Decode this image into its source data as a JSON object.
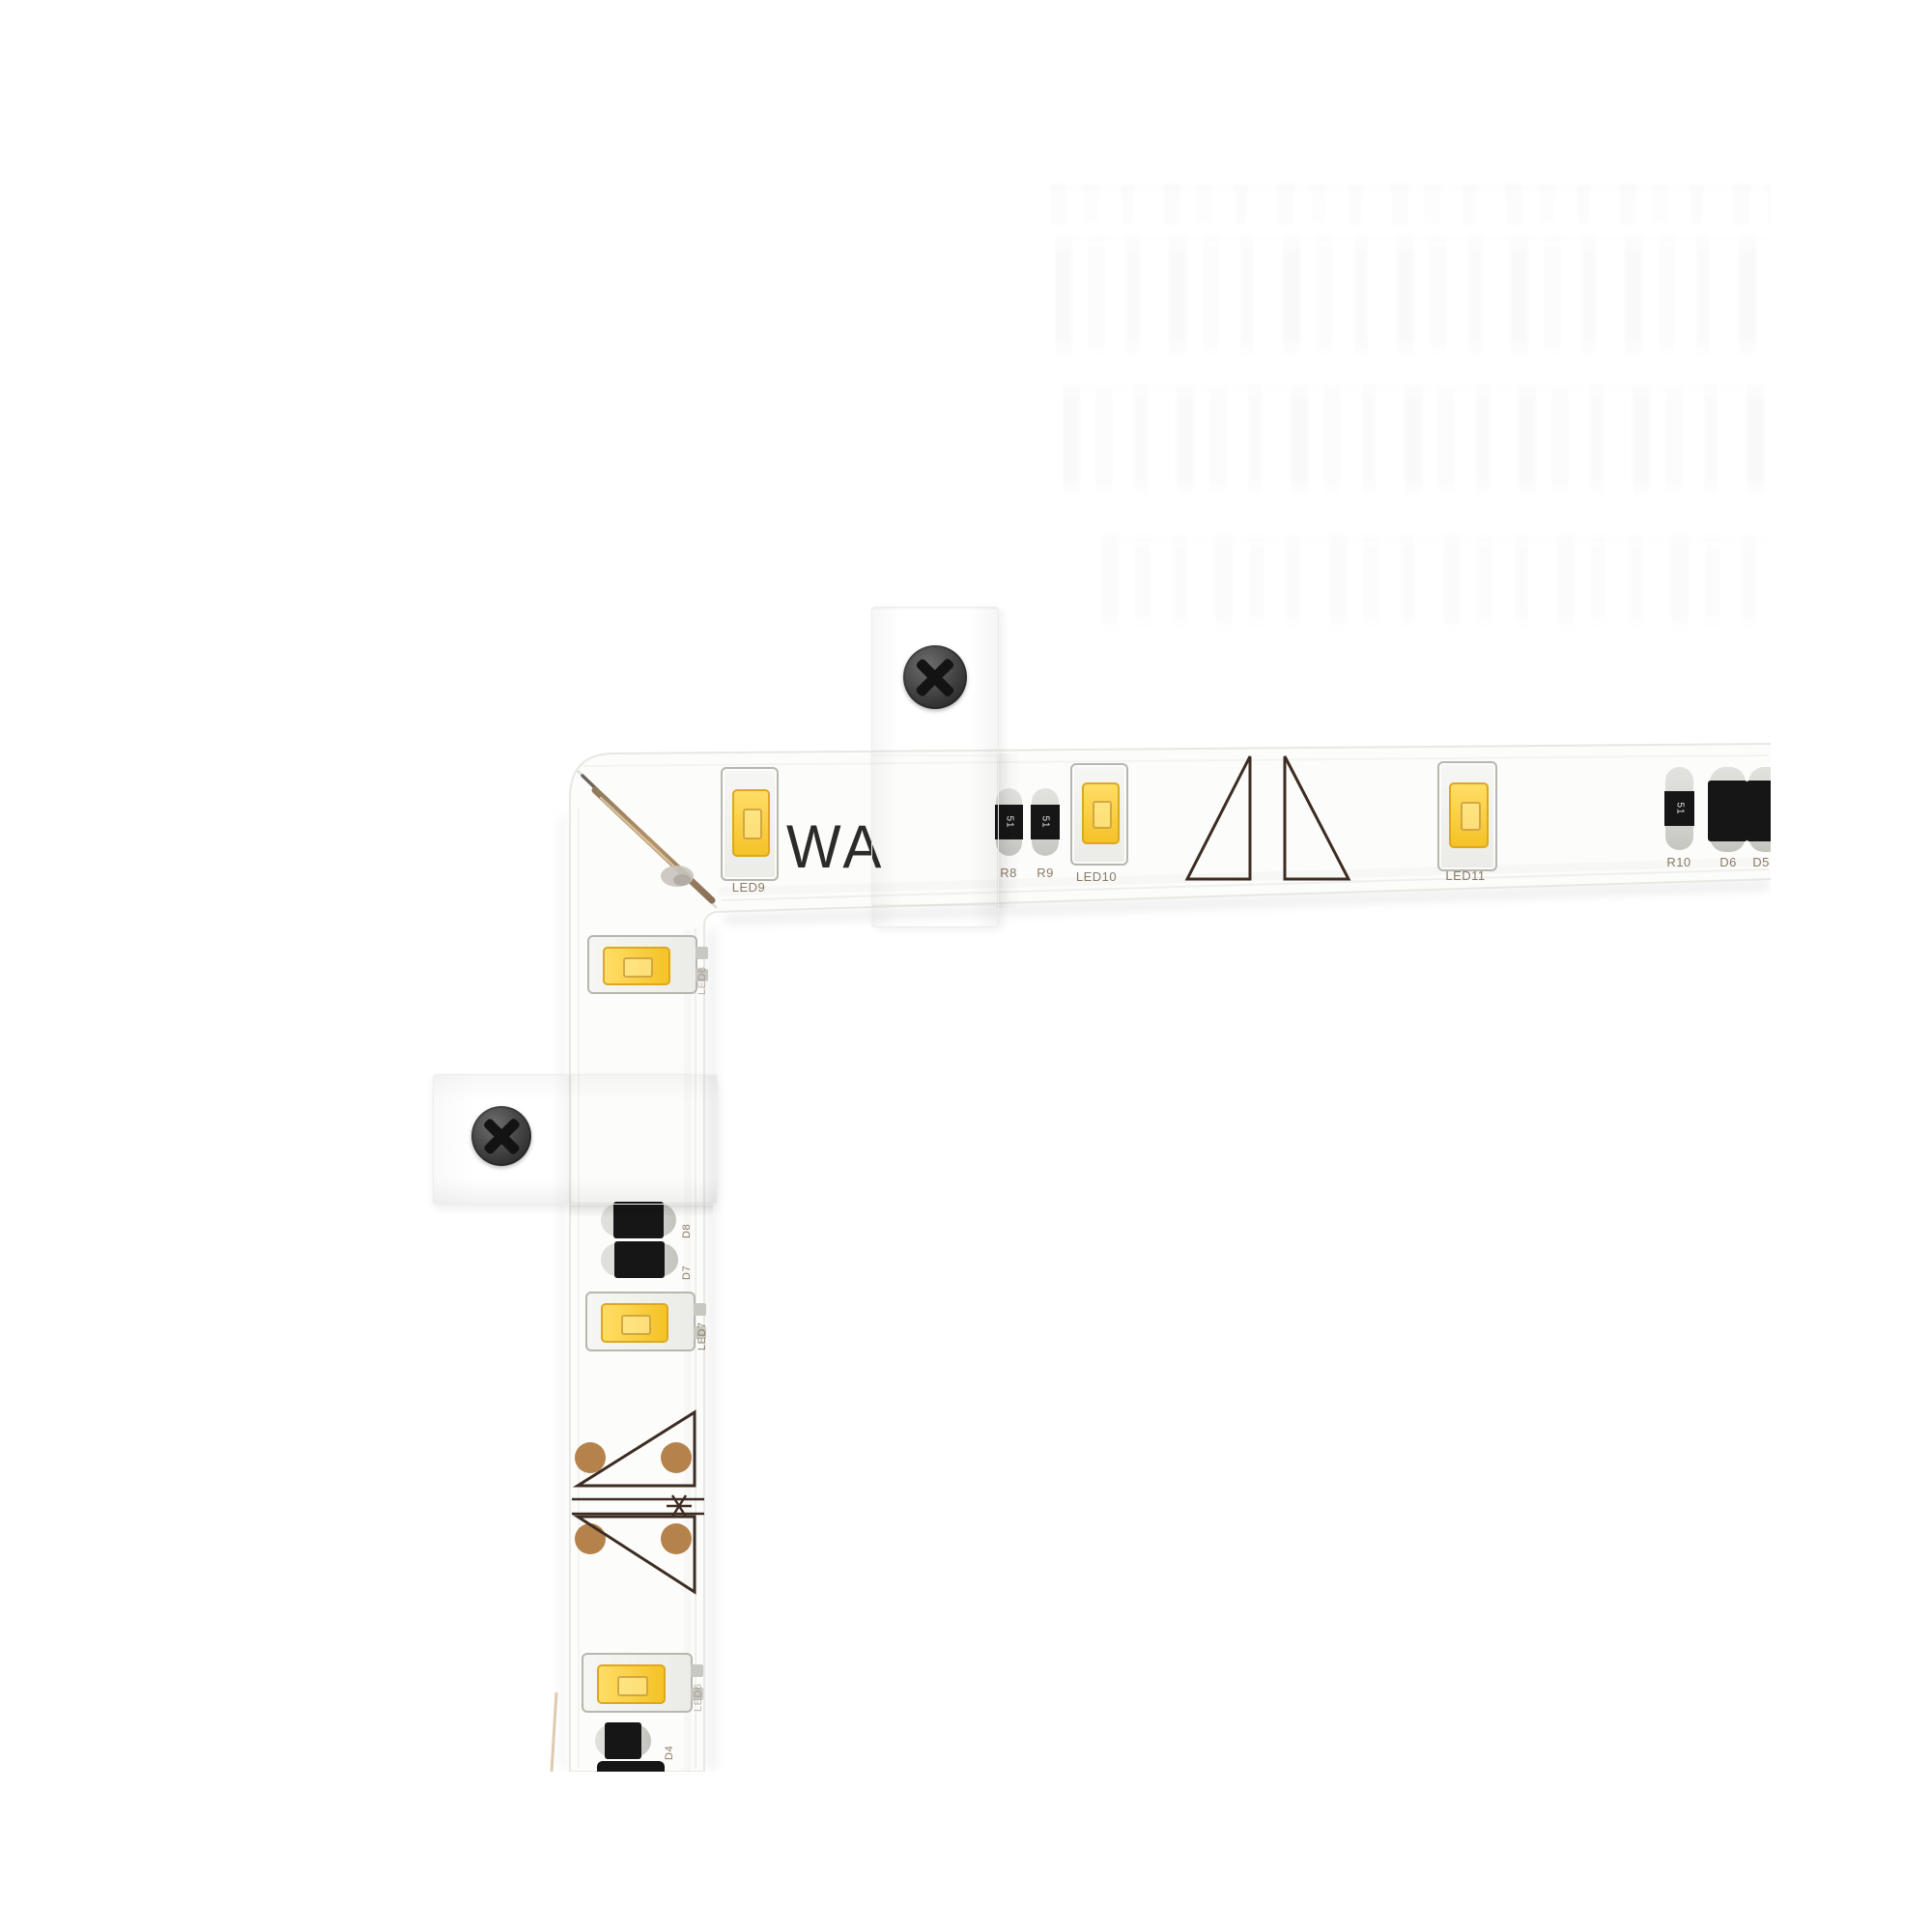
{
  "photo": {
    "brand_partial_text": "WA",
    "strip_labels": {
      "led9": "LED9",
      "r8": "R8",
      "r9": "R9",
      "led10": "LED10",
      "led11": "LED11",
      "r10": "R10",
      "d6": "D6",
      "d5": "D5",
      "led8": "LED8",
      "d8": "D8",
      "d7": "D7",
      "led7": "LED7",
      "led6": "LED6",
      "d4": "D4"
    },
    "chip_markings": {
      "resistor_code": "51"
    },
    "colors": {
      "led_phosphor": "#f5c227",
      "led_phosphor_hi": "#ffdd66",
      "led_phosphor_border": "#dda81e",
      "copper_pad": "#b5824c",
      "cut_mark": "#3d2c21",
      "component_black": "#161616",
      "component_cap": "#d9d9d5",
      "label_text": "#8a7a66",
      "screw_dark": "#333333",
      "strip_white": "#fcfcfb",
      "strip_edge": "#e7e7e3"
    }
  }
}
